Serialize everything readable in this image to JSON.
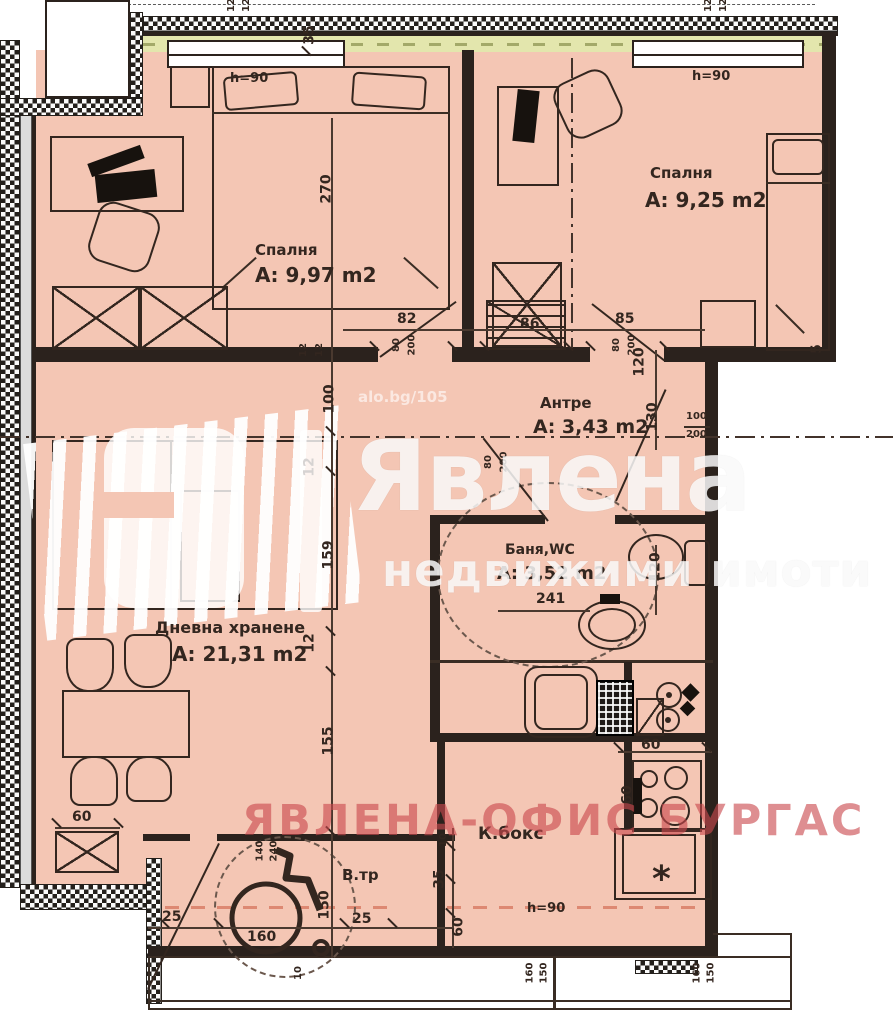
{
  "rooms": {
    "bedroom1": {
      "name": "Спалня",
      "area": "А: 9,97 m2"
    },
    "bedroom2": {
      "name": "Спалня",
      "area": "А: 9,25 m2"
    },
    "hallway": {
      "name": "Антре",
      "area": "А: 3,43 m2"
    },
    "bathroom": {
      "name": "Баня,WC",
      "area": "А: 3,52 m2"
    },
    "living": {
      "name": "Дневна хранене",
      "area": "А: 21,31 m2"
    },
    "kitchen": {
      "name": "К.бокс"
    },
    "terrace": {
      "name": "В.тр"
    }
  },
  "window_labels": {
    "w1": "h=90",
    "w2": "h=90",
    "w3": "h=90"
  },
  "watermarks": {
    "brand": "Явлена",
    "brand_sub": "недвижими имоти",
    "office": "ЯВЛЕНА-ОФИС БУРГАС",
    "listing": "alo.bg/105"
  },
  "symbols": {
    "star": "*"
  },
  "colors": {
    "floor": "#f4c6b4",
    "wall": "#2b221d",
    "band": "#e3e6ad",
    "red_wm": "#c9494d"
  },
  "dims": [
    {
      "t": "12"
    },
    {
      "t": "12"
    },
    {
      "t": "35"
    },
    {
      "t": "12"
    },
    {
      "t": "12"
    },
    {
      "t": "270"
    },
    {
      "t": "12"
    },
    {
      "t": "12"
    },
    {
      "t": "82"
    },
    {
      "t": "80"
    },
    {
      "t": "200"
    },
    {
      "t": "86"
    },
    {
      "t": "85"
    },
    {
      "t": "80"
    },
    {
      "t": "200"
    },
    {
      "t": "120"
    },
    {
      "t": "130"
    },
    {
      "t": "100"
    },
    {
      "t": "200"
    },
    {
      "t": "5"
    },
    {
      "t": "100"
    },
    {
      "t": "12"
    },
    {
      "t": "159"
    },
    {
      "t": "12"
    },
    {
      "t": "155"
    },
    {
      "t": "80"
    },
    {
      "t": "200"
    },
    {
      "t": "241"
    },
    {
      "t": "120"
    },
    {
      "t": "60"
    },
    {
      "t": "60"
    },
    {
      "t": "60"
    },
    {
      "t": "140"
    },
    {
      "t": "240"
    },
    {
      "t": "10"
    },
    {
      "t": "35"
    },
    {
      "t": "60"
    },
    {
      "t": "25"
    },
    {
      "t": "160"
    },
    {
      "t": "150"
    },
    {
      "t": "25"
    },
    {
      "t": "10"
    },
    {
      "t": "160"
    },
    {
      "t": "150"
    },
    {
      "t": "160"
    },
    {
      "t": "150"
    }
  ]
}
